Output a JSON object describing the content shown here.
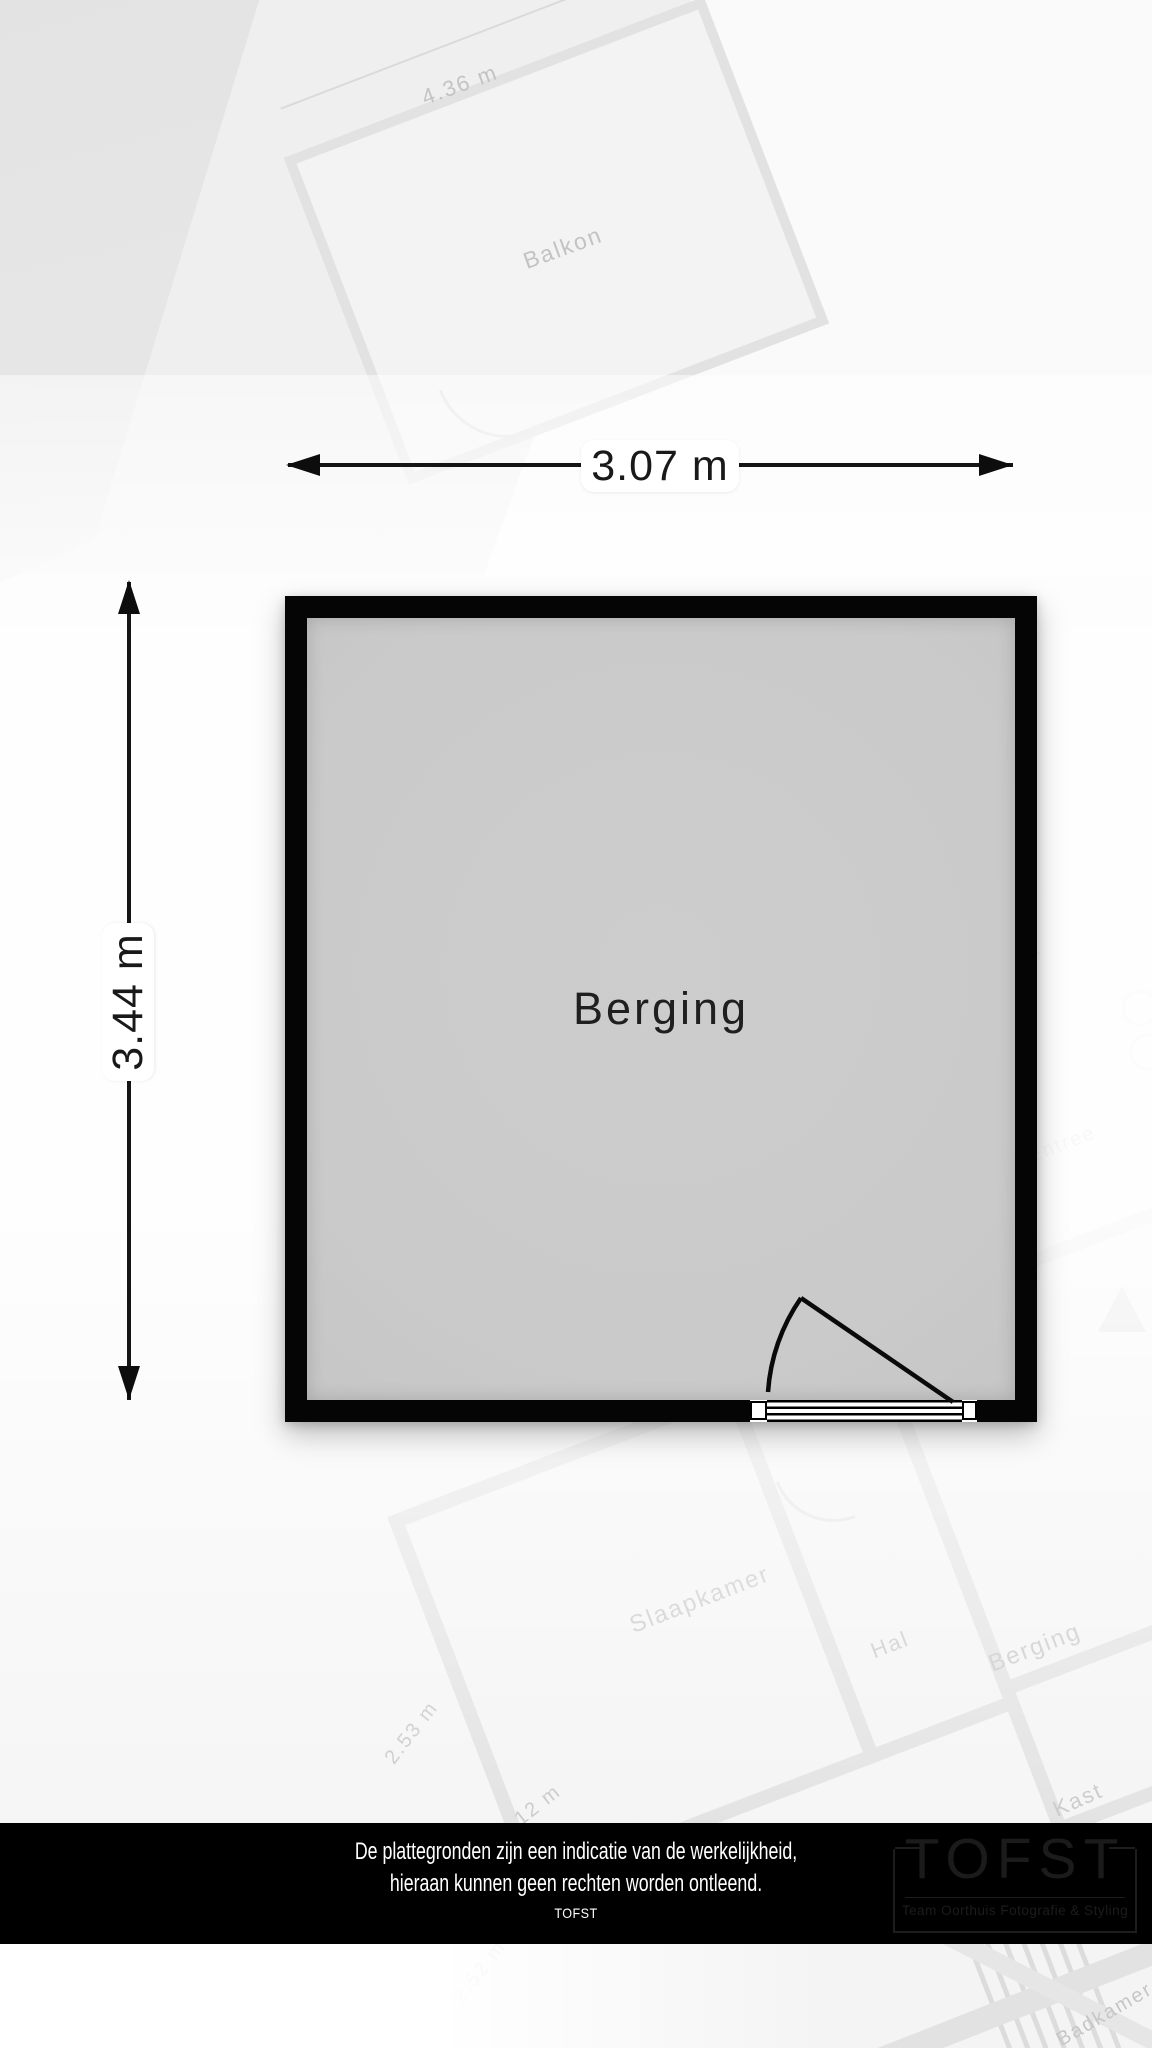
{
  "room": {
    "label": "Berging",
    "width_dimension": "3.07 m",
    "height_dimension": "3.44 m"
  },
  "footer": {
    "disclaimer_line1": "De plattegronden zijn een indicatie van de werkelijkheid,",
    "disclaimer_line2": "hieraan kunnen geen rechten worden ontleend.",
    "brand": "TOFST",
    "logo": {
      "wordmark": "TOFST",
      "tagline": "Team Oorthuis Fotografie & Styling"
    }
  },
  "background_labels": [
    {
      "text": "4.36 m"
    },
    {
      "text": "Balkon"
    },
    {
      "text": "HK"
    },
    {
      "text": "Entree"
    },
    {
      "text": "Slaapkamer"
    },
    {
      "text": "Hal"
    },
    {
      "text": "Berging"
    },
    {
      "text": "Kast"
    },
    {
      "text": "2.53 m"
    },
    {
      "text": "5.12 m"
    },
    {
      "text": "2.52 m"
    },
    {
      "text": "Badkamer"
    }
  ],
  "colors": {
    "wall": "#050505",
    "room_fill": "#cbcbcb",
    "dimension": "#151515",
    "footer_bg": "#000000",
    "footer_text": "#ffffff",
    "watermark": "#c3c3c3"
  }
}
